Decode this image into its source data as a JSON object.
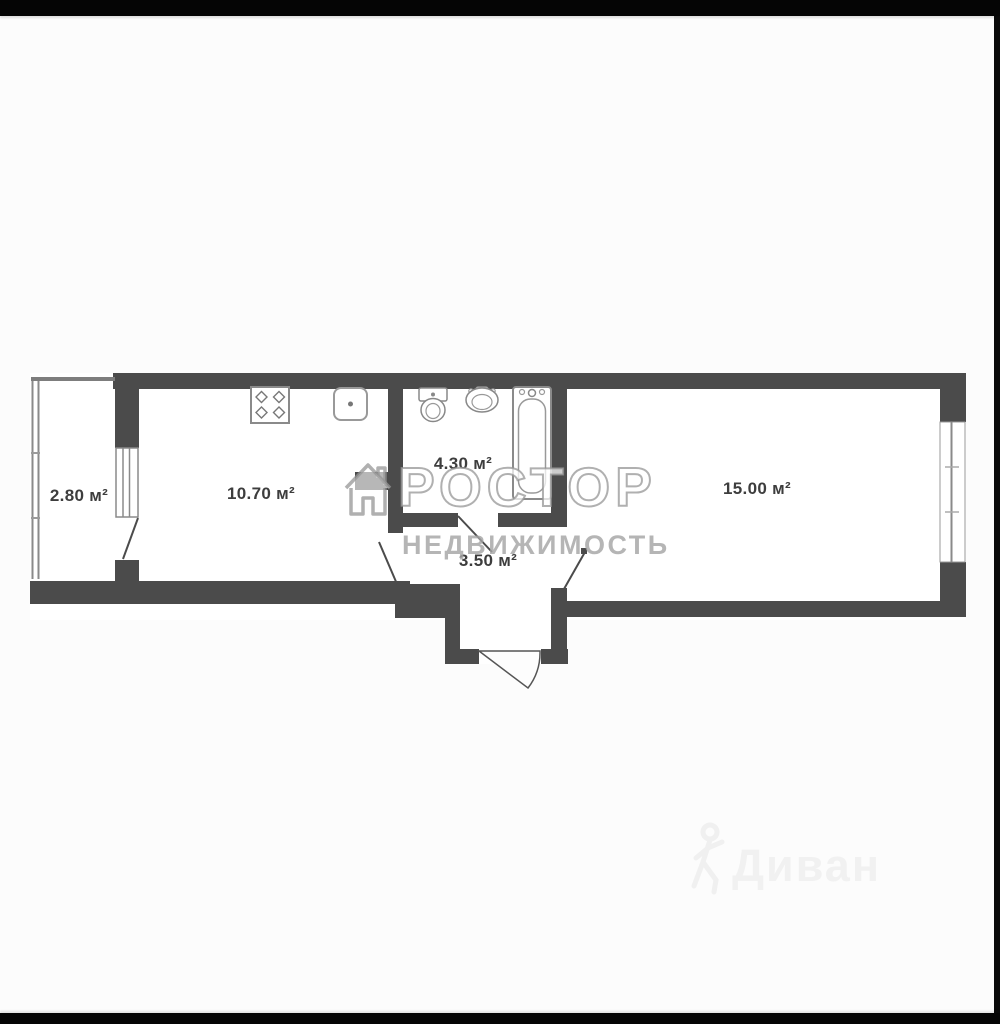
{
  "floorplan": {
    "wall_color": "#4b4b4b",
    "rooms": [
      {
        "key": "balcony",
        "area_label": "2.80 м²"
      },
      {
        "key": "kitchen",
        "area_label": "10.70 м²"
      },
      {
        "key": "bathroom",
        "area_label": "4.30 м²"
      },
      {
        "key": "hallway",
        "area_label": "3.50 м²"
      },
      {
        "key": "living-room",
        "area_label": "15.00 м²"
      }
    ],
    "fixtures": [
      {
        "icon": "stove-icon",
        "room": "kitchen"
      },
      {
        "icon": "kitchen-sink-icon",
        "room": "kitchen"
      },
      {
        "icon": "toilet-icon",
        "room": "bathroom"
      },
      {
        "icon": "washbasin-icon",
        "room": "bathroom"
      },
      {
        "icon": "bathtub-icon",
        "room": "bathroom"
      }
    ]
  },
  "watermarks": {
    "brand_large": "etagi",
    "agency_name": "РОСТОР",
    "agency_subtitle": "НЕДВИЖИМОСТЬ",
    "corner_brand": "Диван"
  }
}
